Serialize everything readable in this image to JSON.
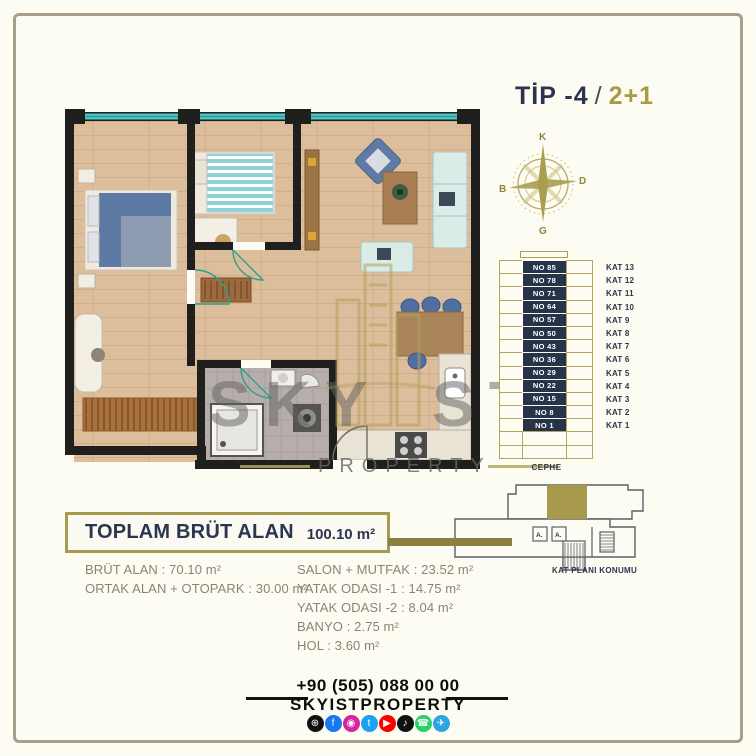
{
  "colors": {
    "navy": "#2b364e",
    "gold": "#a89b52",
    "frame": "#a89e8c",
    "band": "#8c8140",
    "wood": "#dcbd9c",
    "window_teal": "#49c5c6"
  },
  "header": {
    "type": "TİP -4",
    "slash": "/",
    "plan": "2+1"
  },
  "compass": {
    "n": "K",
    "e": "D",
    "s": "G",
    "w": "B"
  },
  "stack": {
    "cephe": "CEPHE",
    "floors": [
      {
        "no": "NO 85",
        "kat": "KAT 13"
      },
      {
        "no": "NO 78",
        "kat": "KAT 12"
      },
      {
        "no": "NO 71",
        "kat": "KAT 11"
      },
      {
        "no": "NO 64",
        "kat": "KAT 10"
      },
      {
        "no": "NO 57",
        "kat": "KAT 9"
      },
      {
        "no": "NO 50",
        "kat": "KAT 8"
      },
      {
        "no": "NO 43",
        "kat": "KAT 7"
      },
      {
        "no": "NO 36",
        "kat": "KAT 6"
      },
      {
        "no": "NO 29",
        "kat": "KAT 5"
      },
      {
        "no": "NO 22",
        "kat": "KAT 4"
      },
      {
        "no": "NO 15",
        "kat": "KAT 3"
      },
      {
        "no": "NO 8",
        "kat": "KAT 2"
      },
      {
        "no": "NO 1",
        "kat": "KAT 1"
      }
    ]
  },
  "location": {
    "label": "KAT PLANI KONUMU",
    "lift_a": "A.",
    "lift_b": "A."
  },
  "summary": {
    "title": "TOPLAM BRÜT ALAN",
    "total": "100.10 m²",
    "left": [
      "BRÜT ALAN : 70.10 m²",
      "ORTAK ALAN + OTOPARK : 30.00 m²"
    ],
    "right": [
      "SALON + MUTFAK : 23.52 m²",
      "YATAK ODASI -1 : 14.75 m²",
      "YATAK ODASI -2 : 8.04 m²",
      "BANYO : 2.75 m²",
      "HOL : 3.60 m²"
    ]
  },
  "watermark": {
    "left": "SKY",
    "right": "ST",
    "sub": "PROPERTY"
  },
  "footer": {
    "phone": "+90 (505) 088 00 00",
    "brand": "SKYISTPROPERTY",
    "social": [
      {
        "name": "website-icon",
        "glyph": "⊕",
        "color": "#111111"
      },
      {
        "name": "facebook-icon",
        "glyph": "f",
        "color": "#1877f2"
      },
      {
        "name": "instagram-icon",
        "glyph": "◉",
        "color": "#d6249f"
      },
      {
        "name": "twitter-icon",
        "glyph": "t",
        "color": "#1da1f2"
      },
      {
        "name": "youtube-icon",
        "glyph": "▶",
        "color": "#ff0000"
      },
      {
        "name": "tiktok-icon",
        "glyph": "♪",
        "color": "#111111"
      },
      {
        "name": "whatsapp-icon",
        "glyph": "☎",
        "color": "#25d366"
      },
      {
        "name": "telegram-icon",
        "glyph": "✈",
        "color": "#2ca5e0"
      }
    ]
  }
}
